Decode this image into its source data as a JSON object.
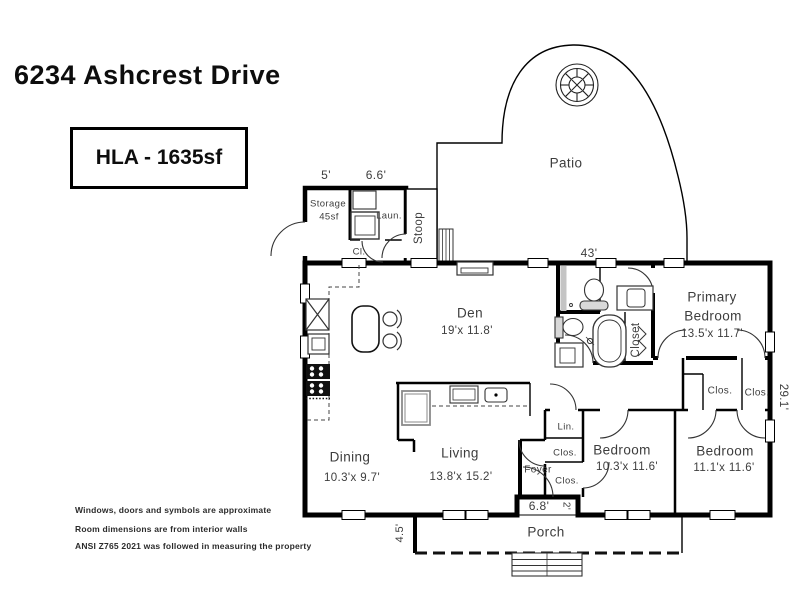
{
  "title": "6234 Ashcrest Drive",
  "hla_box": "HLA - 1635sf",
  "rooms": {
    "patio": "Patio",
    "storage": "Storage",
    "storage_area": "45sf",
    "laundry": "Laun.",
    "closet_small": "Cl.",
    "stoop": "Stoop",
    "den": "Den",
    "den_dims": "19'x 11.8'",
    "primary_line1": "Primary",
    "primary_line2": "Bedroom",
    "primary_dims": "13.5'x 11.7'",
    "primary_closet": "Closet",
    "closet_a": "Clos.",
    "closet_b": "Clos.",
    "dining": "Dining",
    "dining_dims": "10.3'x 9.7'",
    "living": "Living",
    "living_dims": "13.8'x 15.2'",
    "foyer": "Foyer",
    "linen": "Lin.",
    "foyer_closet_1": "Clos.",
    "foyer_closet_2": "Clos.",
    "bedroom2": "Bedroom",
    "bedroom2_dims": "10.3'x 11.6'",
    "bedroom3": "Bedroom",
    "bedroom3_dims": "11.1'x 11.6'",
    "porch": "Porch"
  },
  "dimensions": {
    "storage_width": "5'",
    "laundry_width": "6.6'",
    "main_width": "43'",
    "main_depth": "29.1'",
    "porch_depth": "4.5'",
    "entry_width": "6.8'",
    "entry_jog": "2'"
  },
  "disclaimers": [
    "Windows, doors and symbols are approximate",
    "Room dimensions are from interior walls",
    "ANSI Z765 2021 was followed in measuring the property"
  ],
  "colors": {
    "wall": "#000000",
    "label": "#3d3d3d",
    "fixture_gray": "#c4c4c4"
  }
}
